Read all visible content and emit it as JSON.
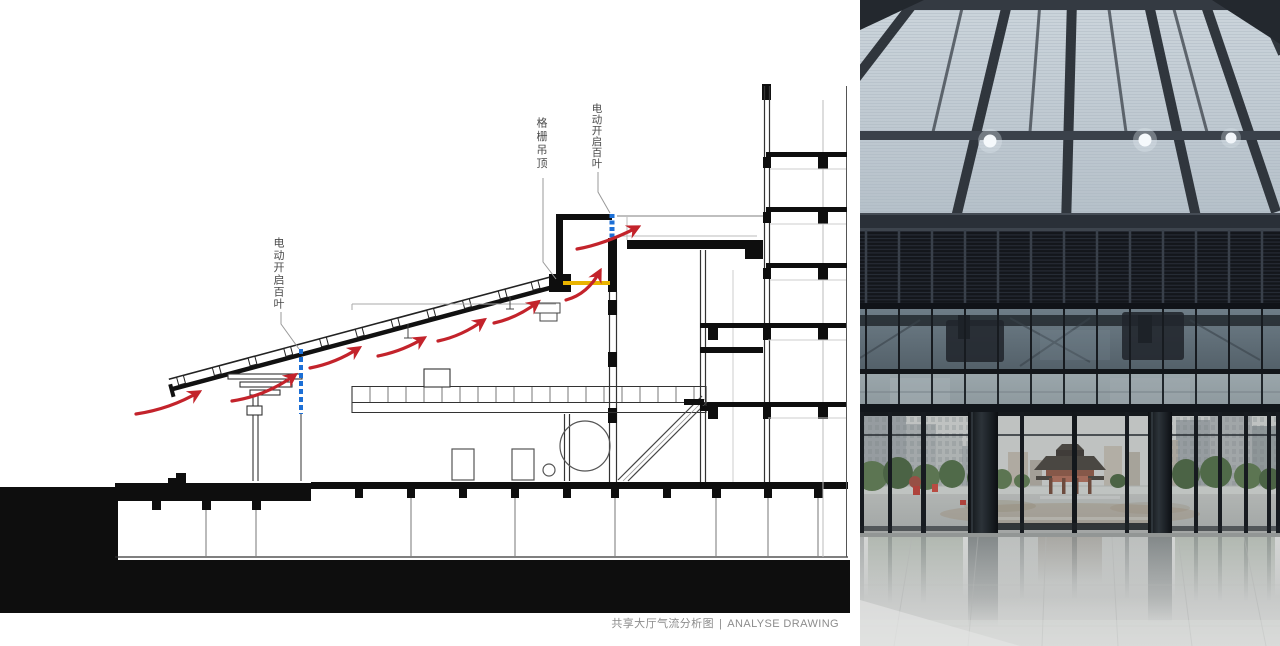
{
  "diagram": {
    "annotations": {
      "canopy_louver_label": "电动开启百叶",
      "grille_ceiling_label": "格栅吊顶",
      "clerestory_louver_label": "电动开启百叶"
    },
    "caption": {
      "title_zh": "共享大厅气流分析图",
      "separator": "|",
      "title_en": "ANALYSE DRAWING"
    },
    "colors": {
      "airflow_arrow_red": "#c3232b",
      "operable_louver_blue": "#1c6fd6",
      "grille_ceiling_yellow": "#e9b400",
      "section_poche": "#0e0e0e",
      "caption_gray": "#8c8c8c"
    }
  },
  "photo": {
    "scene": "shared-hall-interior-view-to-entrance",
    "elements": [
      "glass-skylight-roof",
      "steel-structure",
      "downlights",
      "ventilation-louver-band",
      "glass-curtain-wall",
      "entrance-doors",
      "plaza",
      "traditional-gate",
      "city-buildings",
      "trees",
      "polished-reflective-floor"
    ],
    "colors": {
      "sky_glass": "#c3ced7",
      "steel_dark": "#30363d",
      "louver_dark": "#14171c",
      "floor_light": "#cfd1d0"
    }
  }
}
